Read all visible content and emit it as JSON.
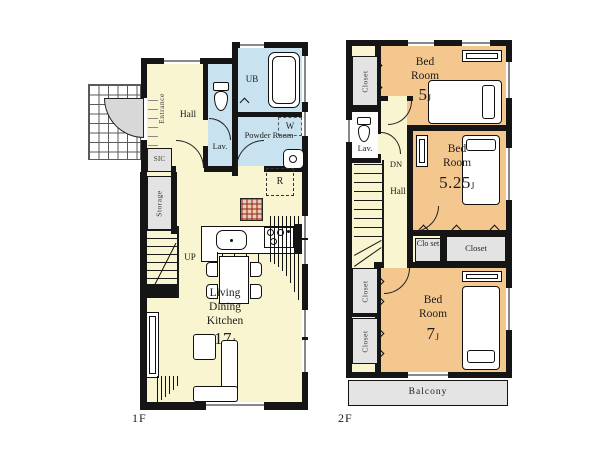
{
  "title": "Floor plan",
  "colors": {
    "wall": "#151515",
    "floor_cream": "#f8f5d0",
    "bedroom_orange": "#f4c78e",
    "bath_blue": "#c8e2ef",
    "closet_gray": "#e3e3e3",
    "accent_red": "#a8402e"
  },
  "floors": [
    {
      "label": "1F",
      "rooms": {
        "entrance": "Entrance",
        "sic": "SIC",
        "storage": "Storage",
        "hall": "Hall",
        "lav": "Lav.",
        "ub": "UB",
        "powder": "Powder Room",
        "washer": "W",
        "fridge": "R",
        "stairs": "UP",
        "ldk": {
          "lines": [
            "Living",
            "Dining",
            "Kitchen"
          ],
          "size": "17",
          "unit": "J"
        }
      }
    },
    {
      "label": "2F",
      "rooms": {
        "closet": "Closet",
        "closet_wrapped": "Clo set",
        "lav": "Lav.",
        "stairs": "DN",
        "hall": "Hall",
        "balcony": "Balcony",
        "bed_word": "Bed",
        "room_word": "Room",
        "bed5": {
          "size": "5",
          "unit": "J"
        },
        "bed525": {
          "size": "5.25",
          "unit": "J"
        },
        "bed7": {
          "size": "7",
          "unit": "J"
        }
      }
    }
  ]
}
